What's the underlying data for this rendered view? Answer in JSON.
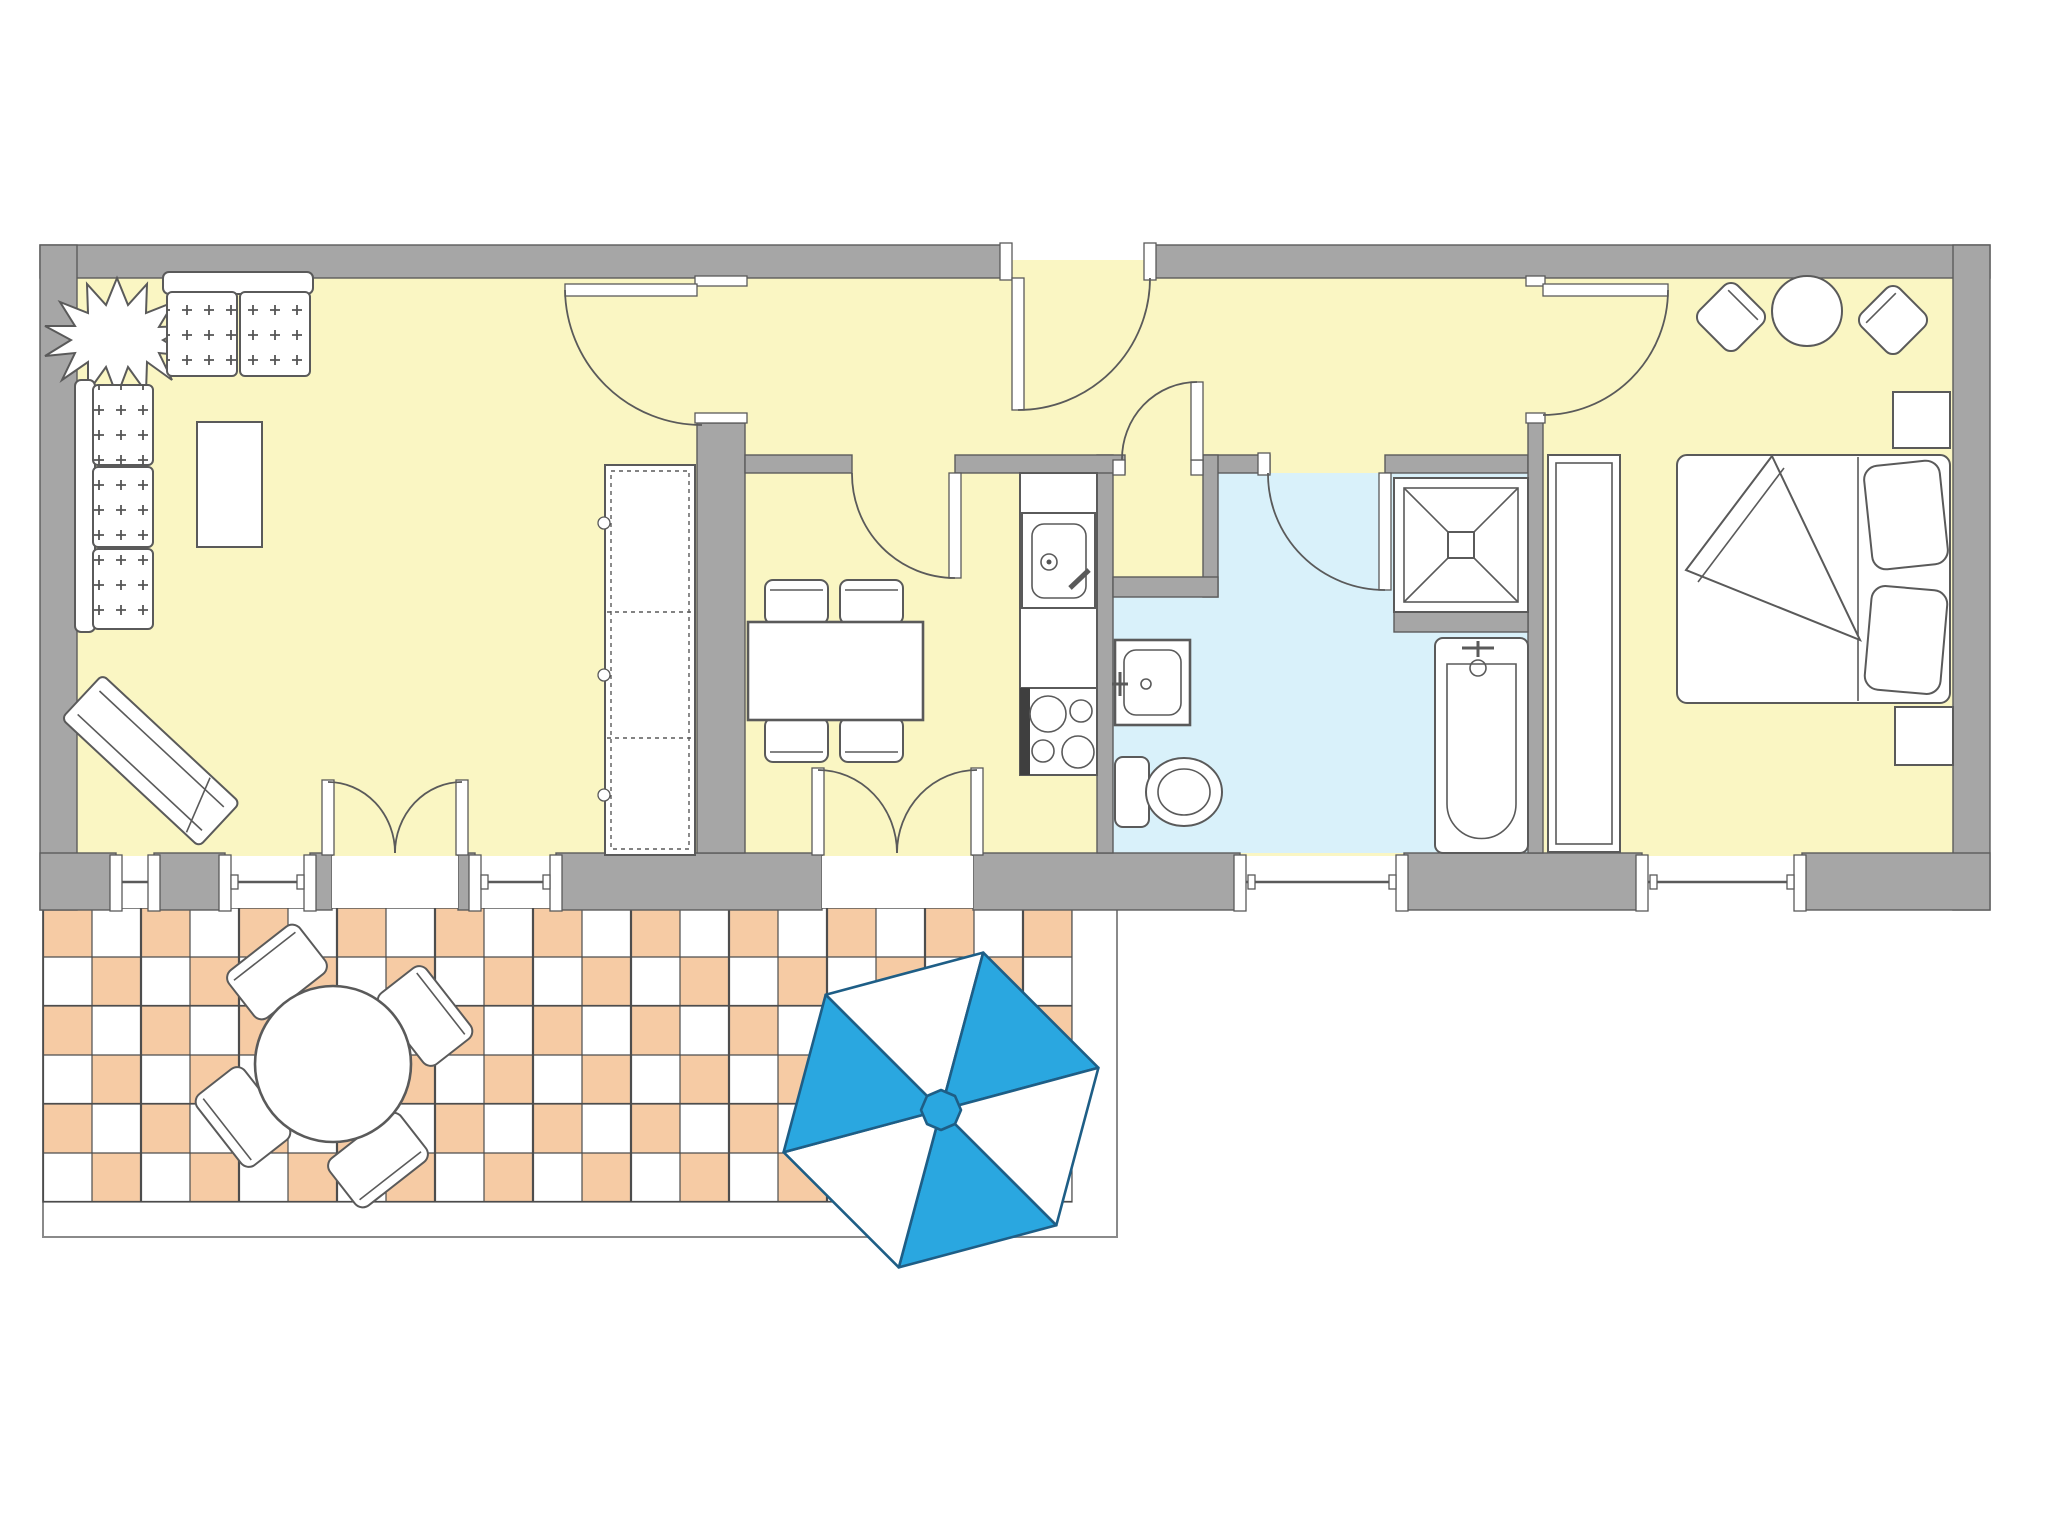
{
  "title": "apartment-floor-plan",
  "colors": {
    "wall": "#a6a6a6",
    "wall-line": "#5c5c5c",
    "floor": "#faf6c3",
    "floor-bath": "#d9f1fa",
    "tile-orange": "#f6cba4",
    "tile-white": "#ffffff",
    "tile-line": "#4d4d4d",
    "line": "#5a5a5a",
    "terrace-line": "#8a8a8a",
    "umbrella": "#2aa7e0",
    "umbrella-line": "#1e5e86"
  },
  "rooms": [
    {
      "id": "living-room",
      "floor": "pale-yellow",
      "furniture": [
        "potted-plant",
        "two-seat-sofa",
        "three-seat-sofa",
        "coffee-table",
        "lounge-chair",
        "wardrobe-cabinet"
      ]
    },
    {
      "id": "hallway",
      "floor": "pale-yellow",
      "furniture": []
    },
    {
      "id": "kitchen",
      "floor": "pale-yellow",
      "furniture": [
        "dining-table",
        "dining-chair-x4",
        "counter-with-sink",
        "cooktop-4-burners"
      ]
    },
    {
      "id": "storage-niche",
      "floor": "pale-yellow",
      "furniture": []
    },
    {
      "id": "bathroom",
      "floor": "light-blue",
      "furniture": [
        "wash-basin",
        "toilet",
        "shower-cabin",
        "bathtub"
      ]
    },
    {
      "id": "bedroom",
      "floor": "pale-yellow",
      "furniture": [
        "armchair-left",
        "round-side-table",
        "armchair-right",
        "double-bed",
        "nightstand-top",
        "nightstand-bottom",
        "wardrobe"
      ]
    },
    {
      "id": "terrace",
      "floor": "checkerboard-tiles",
      "furniture": [
        "round-garden-table",
        "garden-chair-x4",
        "parasol-umbrella"
      ]
    }
  ],
  "openings": {
    "entrance_doors": 1,
    "interior_doors": 5,
    "double_french_doors": 2,
    "windows": 5
  },
  "parasol": {
    "shape": "hexagon",
    "segments": 6,
    "pattern": [
      "white",
      "blue",
      "white",
      "blue",
      "white",
      "blue"
    ]
  },
  "terrace_tiles": {
    "pattern": "checkerboard",
    "cell_px": 49,
    "colors": [
      "orange",
      "white"
    ]
  }
}
